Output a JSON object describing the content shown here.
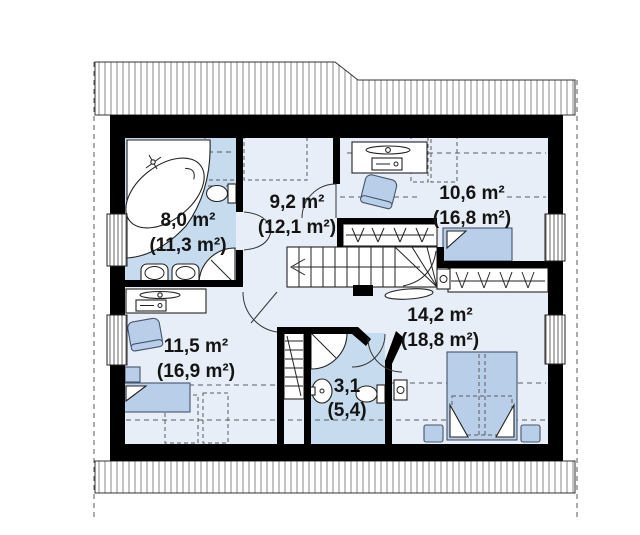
{
  "plan": {
    "type": "attic-floor-plan",
    "rooms": [
      {
        "id": "bathroom-main",
        "area": "8,0 m²",
        "area_gross": "(11,3 m²)"
      },
      {
        "id": "hallway",
        "area": "9,2 m²",
        "area_gross": "(12,1 m²)"
      },
      {
        "id": "bedroom-top-right",
        "area": "10,6 m²",
        "area_gross": "(16,8 m²)"
      },
      {
        "id": "bedroom-bottom-left",
        "area": "11,5 m²",
        "area_gross": "(16,9 m²)"
      },
      {
        "id": "bathroom-small",
        "area": "3,1",
        "area_gross": "(5,4)"
      },
      {
        "id": "bedroom-bottom-right",
        "area": "14,2 m²",
        "area_gross": "(18,8 m²)"
      }
    ],
    "colors": {
      "bathroom_fill": "#c7dbee",
      "room_fill": "#e8eef7",
      "furniture_fill": "#b9cfe9",
      "furniture_stroke": "#44546b",
      "wall_color": "#000000",
      "dash_color": "#5a5a5a",
      "hatch_color": "#8a8a8a"
    }
  }
}
